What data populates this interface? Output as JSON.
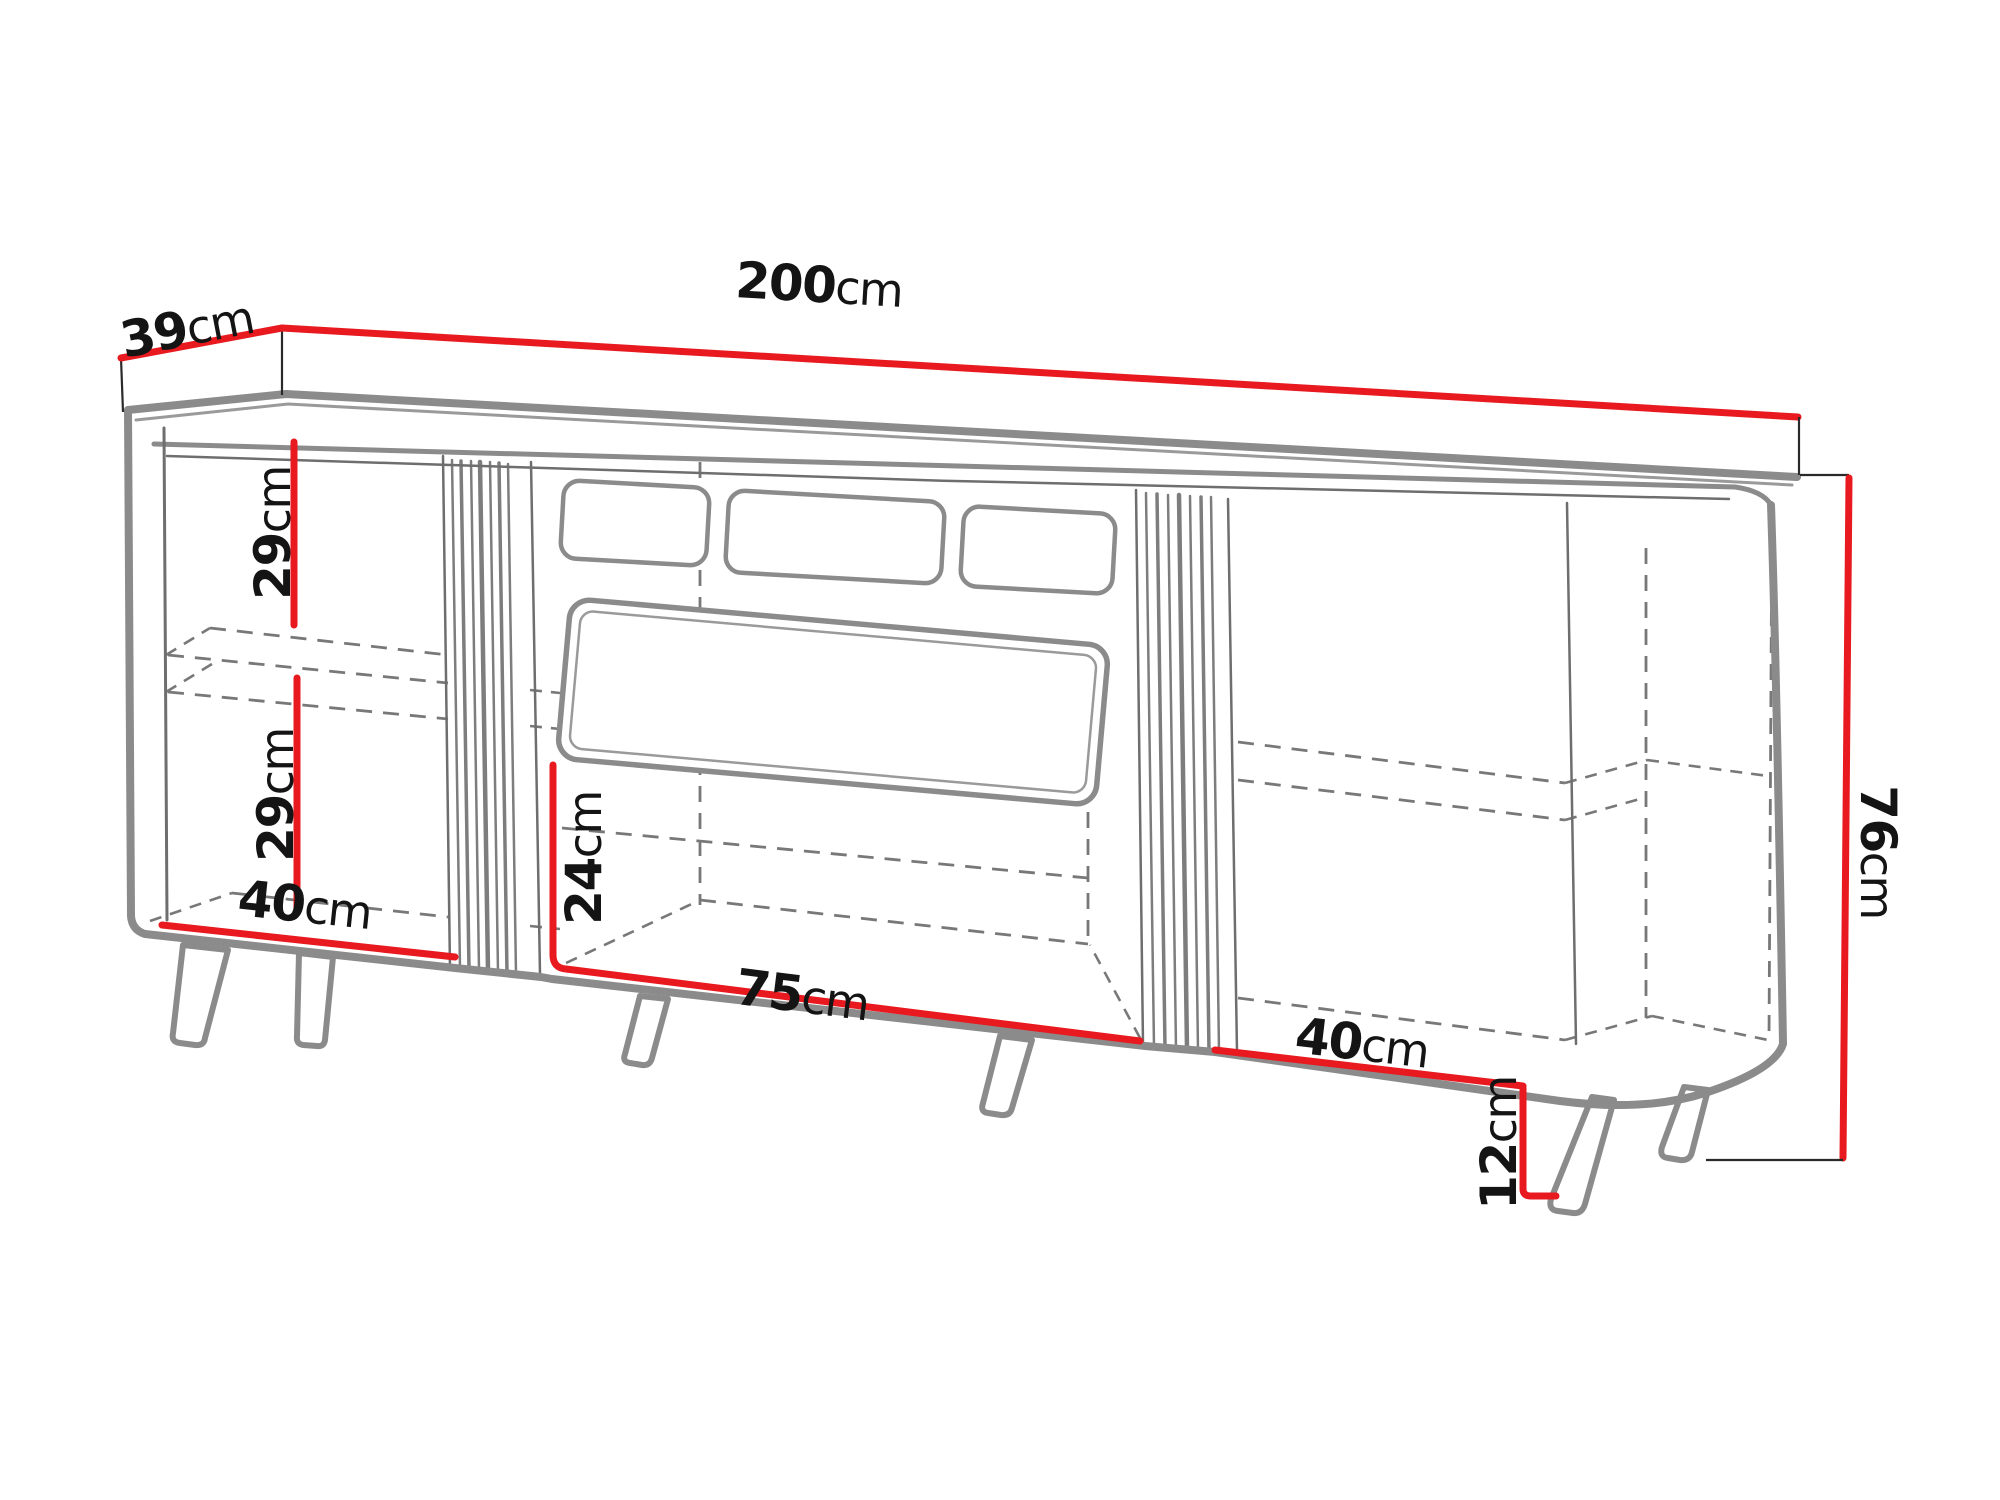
{
  "meta": {
    "type": "furniture-dimension-diagram",
    "subject": "Sideboard / TV cabinet technical line drawing with red dimension lines"
  },
  "dimensions": {
    "depth": {
      "v": "39",
      "u": "cm"
    },
    "width_total": {
      "v": "200",
      "u": "cm"
    },
    "left_upper_compartment_height": {
      "v": "29",
      "u": "cm"
    },
    "left_lower_compartment_height": {
      "v": "29",
      "u": "cm"
    },
    "left_compartment_width": {
      "v": "40",
      "u": "cm"
    },
    "middle_lower_compartment_height": {
      "v": "24",
      "u": "cm"
    },
    "middle_compartment_width": {
      "v": "75",
      "u": "cm"
    },
    "right_compartment_width": {
      "v": "40",
      "u": "cm"
    },
    "leg_height": {
      "v": "12",
      "u": "cm"
    },
    "height_total": {
      "v": "76",
      "u": "cm"
    }
  },
  "colors": {
    "dimension_line": "#e8191f",
    "outline_gray": "#8b8b8b",
    "hidden_line": "#787878",
    "label_text": "#141414",
    "background": "#ffffff"
  }
}
